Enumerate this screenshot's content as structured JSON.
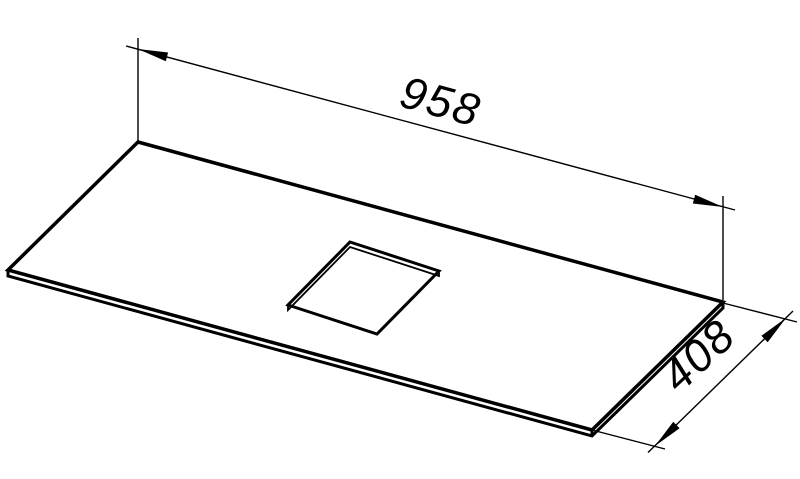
{
  "drawing": {
    "background_color": "#ffffff",
    "line_color": "#000000"
  },
  "dimensions": {
    "width": {
      "label": "958"
    },
    "depth": {
      "label": "408"
    }
  }
}
